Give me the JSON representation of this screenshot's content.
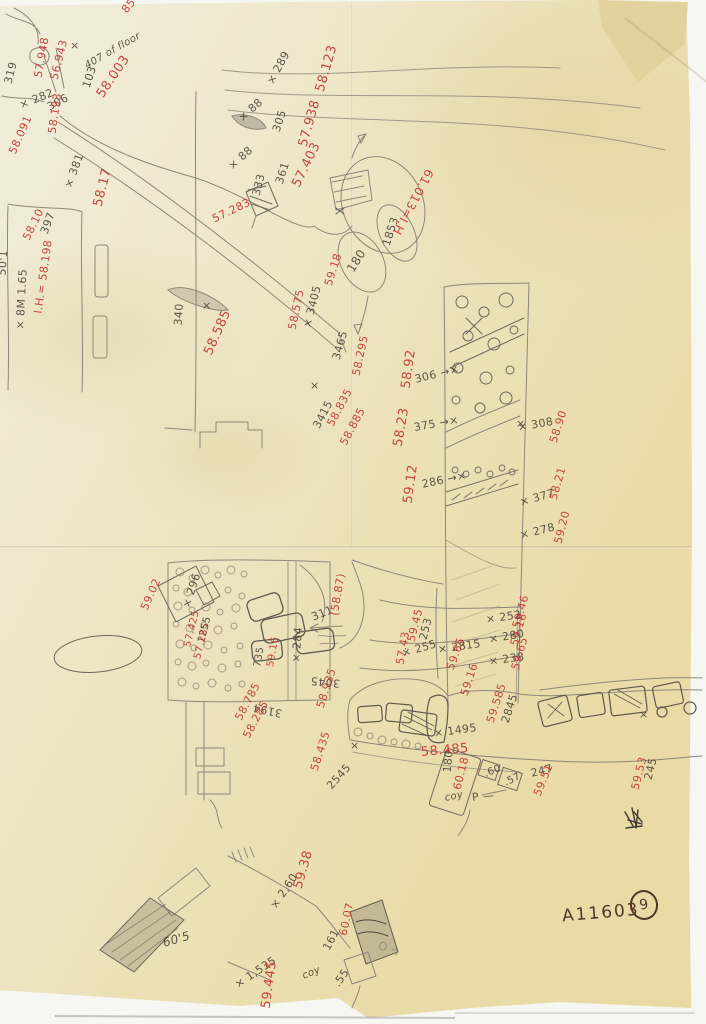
{
  "document": {
    "type_note": "hand-drawn archaeological field plan, pencil with red and black elevation annotations",
    "archive_label": "A11603",
    "page_number": "9"
  },
  "colors": {
    "ink_red": "#c23a36",
    "pencil": "#413c33",
    "ink_brown": "#55352a",
    "paper": "#ece2ba",
    "paper_patch": "#e2d3a2"
  },
  "annotations": [
    {
      "text": "319",
      "x": 8,
      "y": 78,
      "rot": -76,
      "color": "pencil"
    },
    {
      "text": "306",
      "x": 48,
      "y": 102,
      "rot": -28,
      "color": "pencil"
    },
    {
      "text": "407 of floor",
      "x": 86,
      "y": 62,
      "rot": -30,
      "color": "pencil",
      "size": 10,
      "cursive": true
    },
    {
      "text": "57.948",
      "x": 38,
      "y": 72,
      "rot": -80,
      "color": "red"
    },
    {
      "text": "56.943",
      "x": 54,
      "y": 74,
      "rot": -76,
      "color": "red"
    },
    {
      "text": "×",
      "x": 70,
      "y": 40,
      "rot": 0,
      "color": "pencil"
    },
    {
      "text": "103",
      "x": 86,
      "y": 82,
      "rot": -72,
      "color": "pencil"
    },
    {
      "text": "58.003",
      "x": 100,
      "y": 90,
      "rot": -56,
      "color": "red",
      "size": 13
    },
    {
      "text": "85",
      "x": 124,
      "y": 6,
      "rot": -50,
      "color": "red"
    },
    {
      "text": "× 282",
      "x": 20,
      "y": 100,
      "rot": -22,
      "color": "pencil"
    },
    {
      "text": "58.193",
      "x": 52,
      "y": 128,
      "rot": -82,
      "color": "red"
    },
    {
      "text": "58.091",
      "x": 12,
      "y": 148,
      "rot": -66,
      "color": "red"
    },
    {
      "text": "× 381",
      "x": 68,
      "y": 182,
      "rot": -70,
      "color": "pencil"
    },
    {
      "text": "58.17",
      "x": 98,
      "y": 200,
      "rot": -76,
      "color": "red",
      "size": 13
    },
    {
      "text": "397",
      "x": 44,
      "y": 228,
      "rot": -70,
      "color": "pencil"
    },
    {
      "text": "58.10",
      "x": 26,
      "y": 234,
      "rot": -64,
      "color": "red"
    },
    {
      "text": "50'1",
      "x": 2,
      "y": 270,
      "rot": -86,
      "color": "pencil"
    },
    {
      "text": "× 8M 1.65",
      "x": 20,
      "y": 324,
      "rot": -87,
      "color": "pencil"
    },
    {
      "text": "I.H.= 58.198",
      "x": 38,
      "y": 308,
      "rot": -82,
      "color": "red"
    },
    {
      "text": "× 289",
      "x": 270,
      "y": 78,
      "rot": -62,
      "color": "pencil"
    },
    {
      "text": "58.123",
      "x": 320,
      "y": 85,
      "rot": -74,
      "color": "red",
      "size": 13
    },
    {
      "text": "× 88",
      "x": 240,
      "y": 114,
      "rot": -42,
      "color": "pencil"
    },
    {
      "text": "305",
      "x": 276,
      "y": 126,
      "rot": -72,
      "color": "pencil"
    },
    {
      "text": "57.938",
      "x": 303,
      "y": 140,
      "rot": -74,
      "color": "red",
      "size": 13
    },
    {
      "text": "× 88",
      "x": 230,
      "y": 162,
      "rot": -42,
      "color": "pencil"
    },
    {
      "text": "361",
      "x": 279,
      "y": 178,
      "rot": -72,
      "color": "pencil"
    },
    {
      "text": "57.403",
      "x": 296,
      "y": 180,
      "rot": -64,
      "color": "red",
      "size": 13
    },
    {
      "text": "333",
      "x": 256,
      "y": 190,
      "rot": -76,
      "color": "pencil"
    },
    {
      "text": "57.283",
      "x": 213,
      "y": 214,
      "rot": -26,
      "color": "red"
    },
    {
      "text": "61.013=I.H.",
      "x": 430,
      "y": 164,
      "rot": 118,
      "color": "red",
      "size": 12
    },
    {
      "text": "1853",
      "x": 386,
      "y": 240,
      "rot": -72,
      "color": "pencil"
    },
    {
      "text": "180",
      "x": 350,
      "y": 265,
      "rot": -58,
      "color": "pencil",
      "size": 12
    },
    {
      "text": "59.18",
      "x": 328,
      "y": 280,
      "rot": -72,
      "color": "red"
    },
    {
      "text": "340",
      "x": 178,
      "y": 320,
      "rot": -86,
      "color": "pencil"
    },
    {
      "text": "×",
      "x": 202,
      "y": 300,
      "rot": 0,
      "color": "pencil"
    },
    {
      "text": "58.585",
      "x": 208,
      "y": 348,
      "rot": -66,
      "color": "red",
      "size": 13
    },
    {
      "text": "58.575",
      "x": 292,
      "y": 324,
      "rot": -78,
      "color": "red"
    },
    {
      "text": "× 3405",
      "x": 307,
      "y": 322,
      "rot": -76,
      "color": "pencil"
    },
    {
      "text": "3465",
      "x": 336,
      "y": 354,
      "rot": -74,
      "color": "pencil"
    },
    {
      "text": "58.295",
      "x": 356,
      "y": 370,
      "rot": -78,
      "color": "red"
    },
    {
      "text": "×",
      "x": 310,
      "y": 380,
      "rot": 0,
      "color": "pencil"
    },
    {
      "text": "3415",
      "x": 316,
      "y": 422,
      "rot": -62,
      "color": "pencil"
    },
    {
      "text": "58.835",
      "x": 330,
      "y": 420,
      "rot": -62,
      "color": "red"
    },
    {
      "text": "58.885",
      "x": 343,
      "y": 439,
      "rot": -62,
      "color": "red"
    },
    {
      "text": "58.92",
      "x": 406,
      "y": 382,
      "rot": -82,
      "color": "red",
      "size": 13
    },
    {
      "text": "306 →×",
      "x": 415,
      "y": 374,
      "rot": -14,
      "color": "pencil"
    },
    {
      "text": "58.23",
      "x": 398,
      "y": 440,
      "rot": -80,
      "color": "red",
      "size": 13
    },
    {
      "text": "375 →×",
      "x": 414,
      "y": 422,
      "rot": -10,
      "color": "pencil"
    },
    {
      "text": "×",
      "x": 516,
      "y": 418,
      "rot": 0,
      "color": "pencil"
    },
    {
      "text": "59.12",
      "x": 408,
      "y": 497,
      "rot": -82,
      "color": "red",
      "size": 13
    },
    {
      "text": "286 →×",
      "x": 422,
      "y": 479,
      "rot": -12,
      "color": "pencil"
    },
    {
      "text": "× 308",
      "x": 518,
      "y": 422,
      "rot": -10,
      "color": "pencil"
    },
    {
      "text": "58.90",
      "x": 553,
      "y": 437,
      "rot": -72,
      "color": "red"
    },
    {
      "text": "× 377",
      "x": 520,
      "y": 497,
      "rot": -16,
      "color": "pencil"
    },
    {
      "text": "58.21",
      "x": 553,
      "y": 494,
      "rot": -74,
      "color": "red"
    },
    {
      "text": "× 278",
      "x": 520,
      "y": 530,
      "rot": -14,
      "color": "pencil"
    },
    {
      "text": "59.20",
      "x": 558,
      "y": 538,
      "rot": -76,
      "color": "red"
    },
    {
      "text": "× 252",
      "x": 486,
      "y": 614,
      "rot": -8,
      "color": "pencil"
    },
    {
      "text": "59.46",
      "x": 516,
      "y": 622,
      "rot": -74,
      "color": "red"
    },
    {
      "text": "× 280",
      "x": 489,
      "y": 634,
      "rot": -10,
      "color": "pencil"
    },
    {
      "text": "59.18",
      "x": 514,
      "y": 640,
      "rot": -74,
      "color": "red"
    },
    {
      "text": "× 238",
      "x": 489,
      "y": 656,
      "rot": -8,
      "color": "pencil"
    },
    {
      "text": "59.65",
      "x": 515,
      "y": 664,
      "rot": -74,
      "color": "red"
    },
    {
      "text": "253",
      "x": 423,
      "y": 634,
      "rot": -76,
      "color": "pencil"
    },
    {
      "text": "59.45",
      "x": 411,
      "y": 636,
      "rot": -76,
      "color": "red"
    },
    {
      "text": "× 255",
      "x": 402,
      "y": 648,
      "rot": -16,
      "color": "pencil"
    },
    {
      "text": "57.43",
      "x": 400,
      "y": 659,
      "rot": -80,
      "color": "red"
    },
    {
      "text": "× 2815",
      "x": 438,
      "y": 644,
      "rot": -8,
      "color": "pencil"
    },
    {
      "text": "59.65",
      "x": 450,
      "y": 664,
      "rot": -70,
      "color": "red"
    },
    {
      "text": "59.16",
      "x": 464,
      "y": 690,
      "rot": -72,
      "color": "red"
    },
    {
      "text": "59.585",
      "x": 490,
      "y": 717,
      "rot": -72,
      "color": "red"
    },
    {
      "text": "2845",
      "x": 505,
      "y": 717,
      "rot": -72,
      "color": "pencil"
    },
    {
      "text": "× 1495",
      "x": 434,
      "y": 728,
      "rot": -8,
      "color": "pencil"
    },
    {
      "text": "58.485",
      "x": 421,
      "y": 746,
      "rot": -5,
      "color": "red",
      "size": 13
    },
    {
      "text": "58.435",
      "x": 314,
      "y": 765,
      "rot": -72,
      "color": "red"
    },
    {
      "text": "2545",
      "x": 329,
      "y": 782,
      "rot": -48,
      "color": "pencil"
    },
    {
      "text": "×",
      "x": 350,
      "y": 740,
      "rot": 0,
      "color": "pencil"
    },
    {
      "text": "180",
      "x": 447,
      "y": 767,
      "rot": -84,
      "color": "pencil"
    },
    {
      "text": "60.18",
      "x": 457,
      "y": 784,
      "rot": -76,
      "color": "red"
    },
    {
      "text": ".60",
      "x": 485,
      "y": 770,
      "rot": -22,
      "color": "pencil",
      "size": 10
    },
    {
      "text": ".57",
      "x": 505,
      "y": 779,
      "rot": -26,
      "color": "pencil",
      "size": 10
    },
    {
      "text": "coy",
      "x": 445,
      "y": 794,
      "rot": -12,
      "color": "pencil",
      "size": 10,
      "cursive": true
    },
    {
      "text": "P —",
      "x": 472,
      "y": 792,
      "rot": -6,
      "color": "pencil"
    },
    {
      "text": "247",
      "x": 531,
      "y": 768,
      "rot": -14,
      "color": "pencil"
    },
    {
      "text": "59.51",
      "x": 537,
      "y": 790,
      "rot": -68,
      "color": "red"
    },
    {
      "text": "59.53",
      "x": 635,
      "y": 784,
      "rot": -76,
      "color": "red"
    },
    {
      "text": "245",
      "x": 648,
      "y": 774,
      "rot": -76,
      "color": "pencil"
    },
    {
      "text": "×",
      "x": 639,
      "y": 709,
      "rot": 0,
      "color": "pencil"
    },
    {
      "text": "59.02",
      "x": 144,
      "y": 604,
      "rot": -66,
      "color": "red"
    },
    {
      "text": "× 296",
      "x": 186,
      "y": 602,
      "rot": -72,
      "color": "pencil"
    },
    {
      "text": "1255",
      "x": 202,
      "y": 638,
      "rot": -76,
      "color": "pencil",
      "size": 10
    },
    {
      "text": "57.425",
      "x": 188,
      "y": 642,
      "rot": -76,
      "color": "red",
      "size": 10
    },
    {
      "text": "57.285",
      "x": 198,
      "y": 654,
      "rot": -76,
      "color": "red",
      "size": 10
    },
    {
      "text": "735",
      "x": 258,
      "y": 662,
      "rot": -80,
      "color": "pencil",
      "size": 10
    },
    {
      "text": "59.16",
      "x": 271,
      "y": 662,
      "rot": -80,
      "color": "red",
      "size": 10
    },
    {
      "text": "× 284",
      "x": 296,
      "y": 657,
      "rot": -86,
      "color": "pencil"
    },
    {
      "text": "3045",
      "x": 340,
      "y": 678,
      "rot": 186,
      "color": "pencil"
    },
    {
      "text": "58.935",
      "x": 320,
      "y": 702,
      "rot": -72,
      "color": "red"
    },
    {
      "text": "3194",
      "x": 282,
      "y": 708,
      "rot": 192,
      "color": "pencil"
    },
    {
      "text": "58.785",
      "x": 238,
      "y": 714,
      "rot": -62,
      "color": "red"
    },
    {
      "text": "58.285",
      "x": 246,
      "y": 732,
      "rot": -62,
      "color": "red"
    },
    {
      "text": "311",
      "x": 312,
      "y": 612,
      "rot": -22,
      "color": "pencil"
    },
    {
      "text": "(58.87)",
      "x": 334,
      "y": 610,
      "rot": -80,
      "color": "red"
    },
    {
      "text": "59.38",
      "x": 298,
      "y": 882,
      "rot": -74,
      "color": "red",
      "size": 13
    },
    {
      "text": "× 2,60",
      "x": 273,
      "y": 902,
      "rot": -56,
      "color": "pencil"
    },
    {
      "text": "161",
      "x": 326,
      "y": 944,
      "rot": -62,
      "color": "pencil"
    },
    {
      "text": "60.07",
      "x": 343,
      "y": 930,
      "rot": -78,
      "color": "red"
    },
    {
      "text": "× 1,535",
      "x": 236,
      "y": 980,
      "rot": -34,
      "color": "pencil"
    },
    {
      "text": "59.445",
      "x": 266,
      "y": 1002,
      "rot": -82,
      "color": "red",
      "size": 13
    },
    {
      "text": ".55",
      "x": 336,
      "y": 980,
      "rot": -56,
      "color": "pencil"
    },
    {
      "text": "coy",
      "x": 303,
      "y": 972,
      "rot": -22,
      "color": "pencil",
      "size": 10,
      "cursive": true
    },
    {
      "text": "60'5",
      "x": 163,
      "y": 937,
      "rot": -16,
      "color": "pencil",
      "size": 12,
      "cursive": true
    }
  ]
}
